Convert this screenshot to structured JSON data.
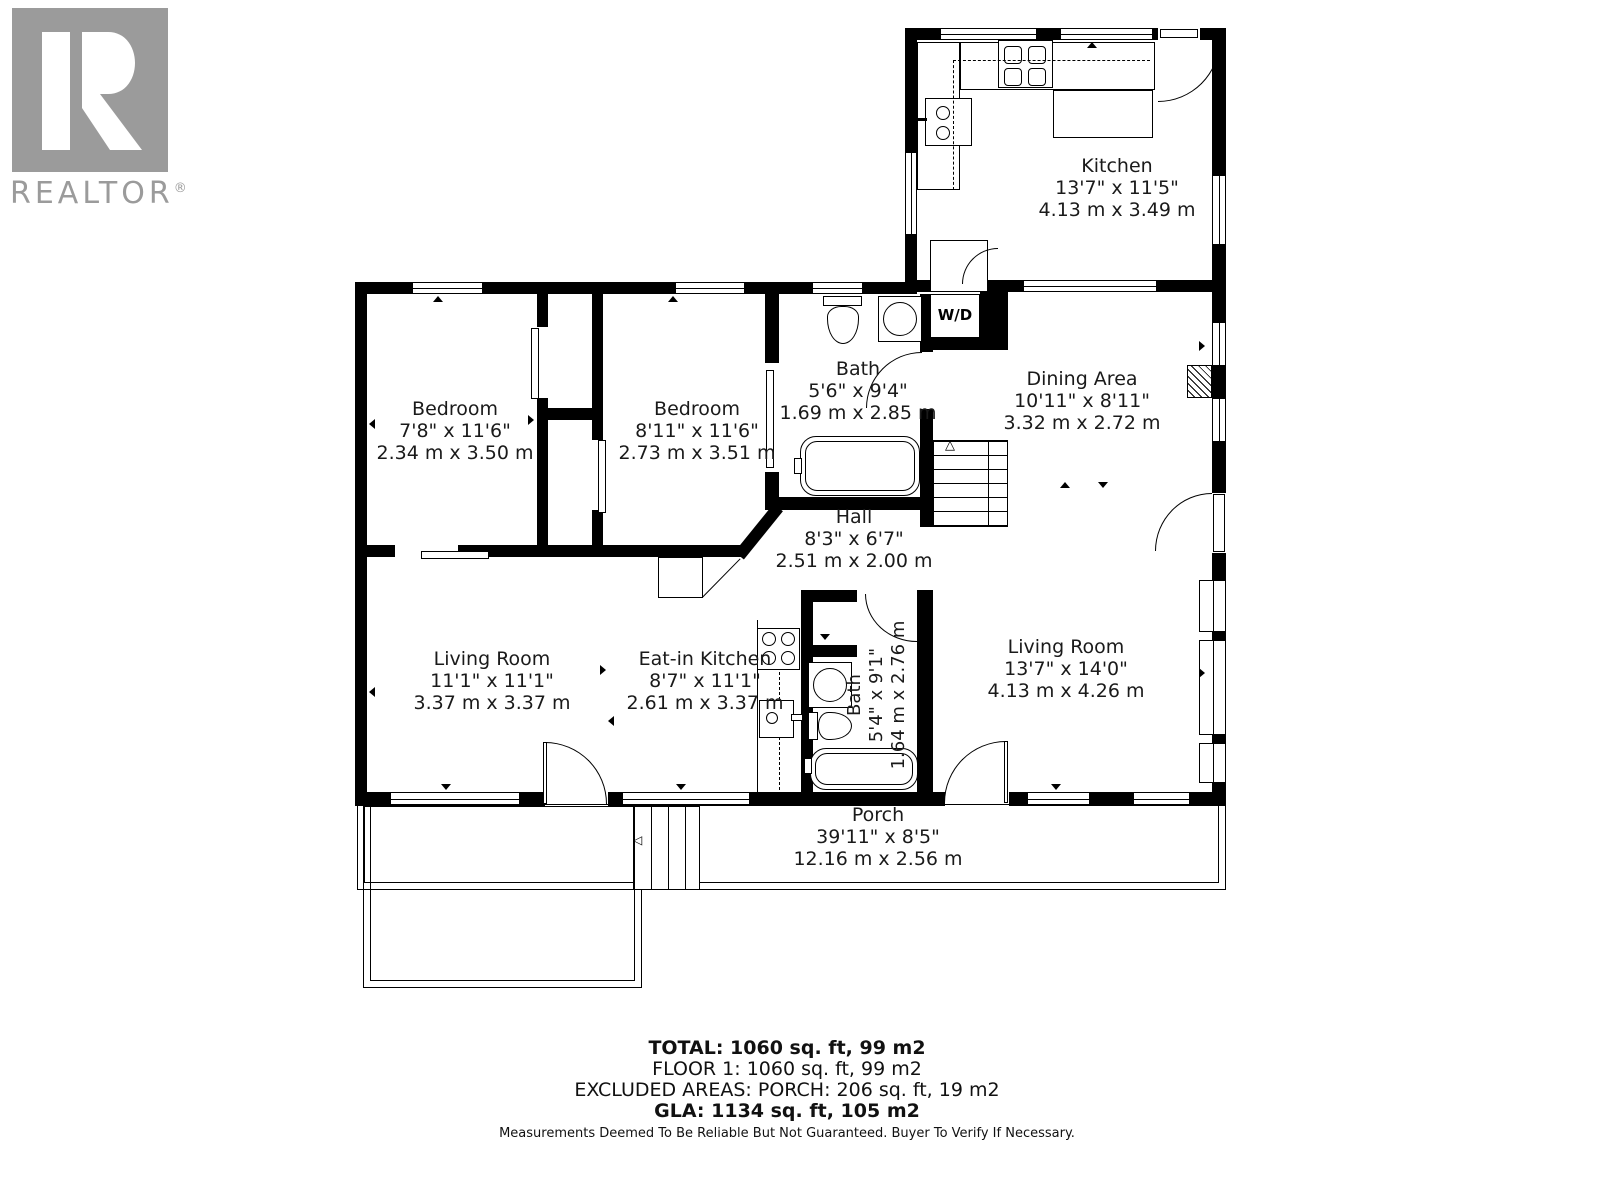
{
  "logo": {
    "brand": "REALTOR",
    "reg": "®"
  },
  "rooms": {
    "kitchen": {
      "name": "Kitchen",
      "imperial": "13'7\" x 11'5\"",
      "metric": "4.13 m x 3.49 m"
    },
    "dining": {
      "name": "Dining Area",
      "imperial": "10'11\" x 8'11\"",
      "metric": "3.32 m x 2.72 m"
    },
    "bedroom1": {
      "name": "Bedroom",
      "imperial": "7'8\" x 11'6\"",
      "metric": "2.34 m x 3.50 m"
    },
    "bedroom2": {
      "name": "Bedroom",
      "imperial": "8'11\" x 11'6\"",
      "metric": "2.73 m x 3.51 m"
    },
    "bath1": {
      "name": "Bath",
      "imperial": "5'6\" x 9'4\"",
      "metric": "1.69 m x 2.85 m"
    },
    "hall": {
      "name": "Hall",
      "imperial": "8'3\" x 6'7\"",
      "metric": "2.51 m x 2.00 m"
    },
    "living1": {
      "name": "Living Room",
      "imperial": "11'1\" x 11'1\"",
      "metric": "3.37 m x 3.37 m"
    },
    "eatin": {
      "name": "Eat-in Kitchen",
      "imperial": "8'7\" x 11'1\"",
      "metric": "2.61 m x 3.37 m"
    },
    "bath2": {
      "name": "Bath",
      "imperial": "5'4\" x 9'1\"",
      "metric": "1.64 m x 2.76 m"
    },
    "living2": {
      "name": "Living Room",
      "imperial": "13'7\" x 14'0\"",
      "metric": "4.13 m x 4.26 m"
    },
    "porch": {
      "name": "Porch",
      "imperial": "39'11\" x 8'5\"",
      "metric": "12.16 m x 2.56 m"
    }
  },
  "labels": {
    "washer_dryer": "W/D"
  },
  "summary": {
    "total": "TOTAL: 1060 sq. ft, 99 m2",
    "floor1": "FLOOR 1: 1060 sq. ft, 99 m2",
    "excluded": "EXCLUDED AREAS: PORCH: 206 sq. ft, 19 m2",
    "gla": "GLA: 1134 sq. ft, 105 m2",
    "disclaimer": "Measurements Deemed To Be Reliable But Not Guaranteed. Buyer To Verify If Necessary."
  },
  "colors": {
    "wall": "#000000",
    "logo_gray": "#9b9b9b",
    "background": "#ffffff"
  }
}
